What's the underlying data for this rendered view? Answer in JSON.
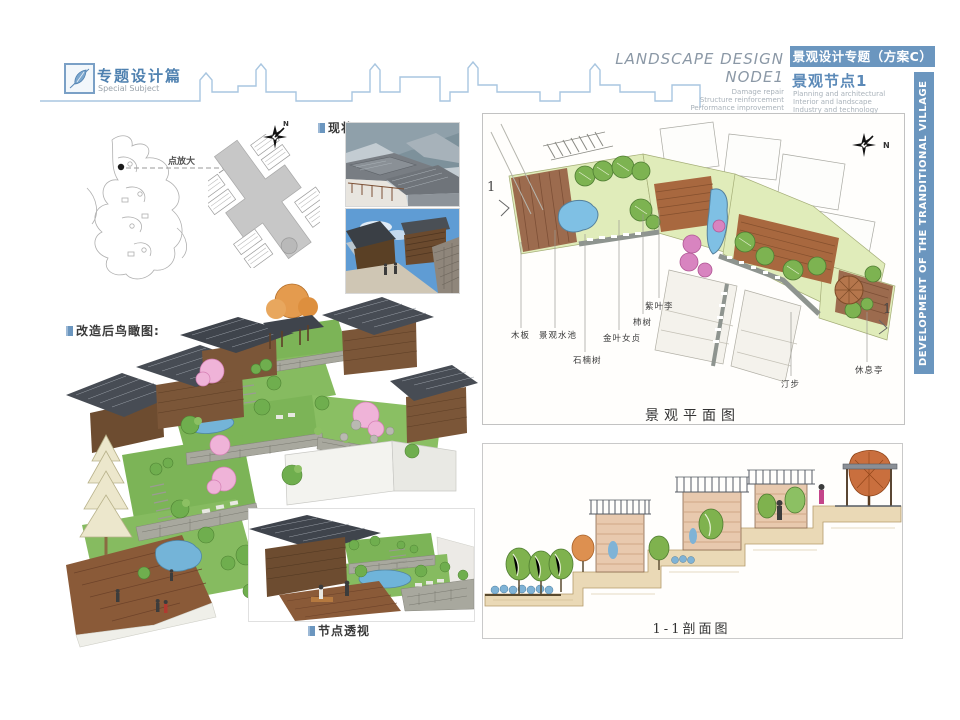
{
  "header": {
    "logo_title": "专题设计篇",
    "logo_subtitle": "Special Subject",
    "right_title_line1": "LANDSCAPE DESIGN",
    "right_title_line2": "NODE1",
    "right_sub": [
      "Damage repair",
      "Structure reinforcement",
      "Performance improvement"
    ],
    "banner_cn": "景观设计专题（方案C）",
    "node_cn": "景观节点1",
    "node_sub": [
      "Planning and architectural",
      "Interior and landscape",
      "Industry and technology"
    ],
    "side_text": "DEVELOPMENT OF THE TRANDITIONAL VILLAGE IN TONGLE"
  },
  "maps": {
    "zoom_label": "点放大",
    "north_label": "N"
  },
  "status": {
    "label": "现状:"
  },
  "aerial": {
    "label": "改造后鸟瞰图:",
    "inset_label": "节点透视"
  },
  "plan": {
    "title": "景观平面图",
    "north_label": "N",
    "marker_left": "1",
    "marker_right": "1",
    "labels": [
      "木板",
      "景观水池",
      "石楠树",
      "金叶女贞",
      "柿树",
      "紫叶李",
      "汀步",
      "休息亭"
    ]
  },
  "section": {
    "title": "1-1剖面图"
  },
  "colors": {
    "accent_blue": "#6b96bf",
    "skyline_blue": "#a9c6e0",
    "text_blue": "#4f81b0",
    "text_gray": "#9aa3ab",
    "lawn_green": "#7cb457",
    "deck_brown": "#8a5a38",
    "water_blue": "#6fb4da",
    "roof_slate": "#474c54"
  }
}
